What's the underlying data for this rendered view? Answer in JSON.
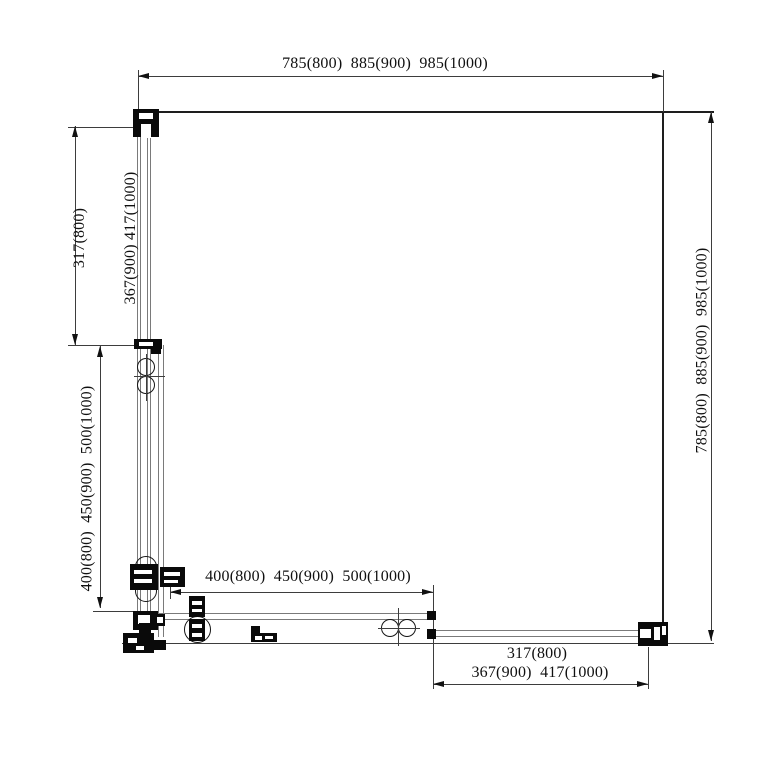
{
  "drawing": {
    "type": "shower-enclosure-corner-entry-plan",
    "dim_labels": {
      "top": "785(800)  885(900)  985(1000)",
      "right": "785(800)  885(900)  985(1000)",
      "left_upper": {
        "line1": "317(800)",
        "line2": "367(900) 417(1000)"
      },
      "left_lower": "400(800)  450(900)  500(1000)",
      "bottom_middle": "400(800)  450(900)  500(1000)",
      "bottom_right": {
        "line1": "317(800)",
        "line2": "367(900)  417(1000)"
      }
    },
    "colors": {
      "background": "#ffffff",
      "dimension_line": "#3d3d3d",
      "glass_line": "#7a7a7a",
      "wall_line": "#1e1e1e",
      "hardware": "#0a0a0a",
      "text": "#101010"
    }
  }
}
